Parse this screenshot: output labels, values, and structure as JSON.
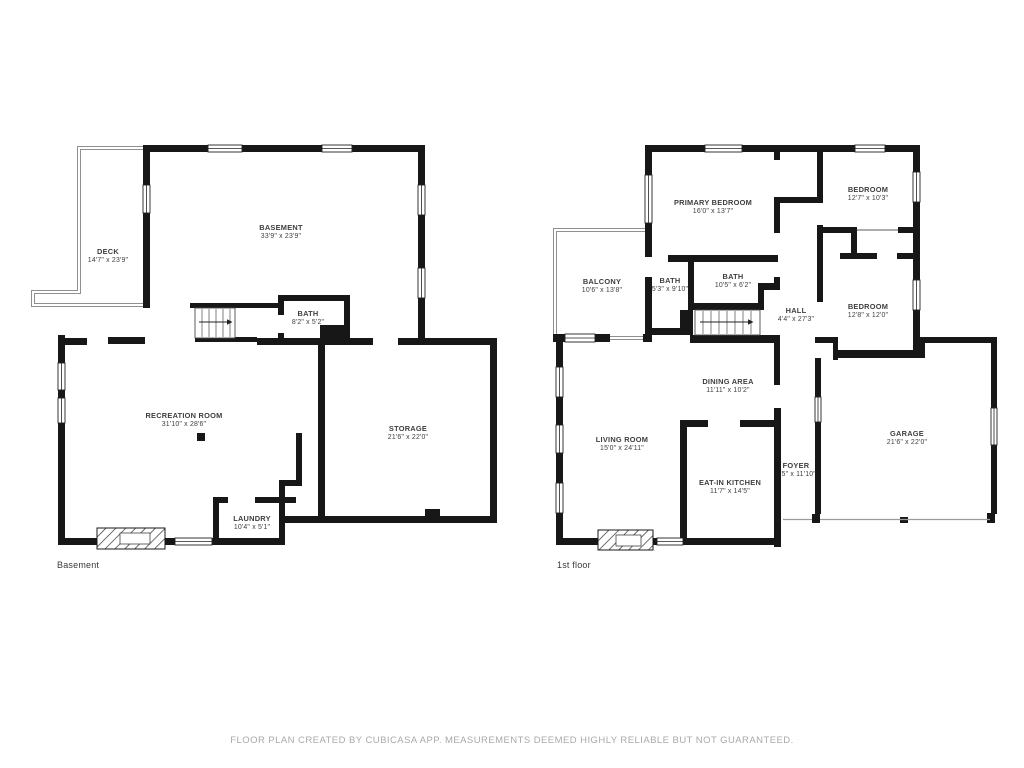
{
  "page": {
    "background": "#ffffff",
    "wall_color": "#171717",
    "label_color": "#3e3e3e",
    "disclaimer_color": "#a9a9a9"
  },
  "floors": [
    {
      "caption": "Basement",
      "rooms": [
        {
          "name": "DECK",
          "dims": "14'7\" x 23'9\""
        },
        {
          "name": "BASEMENT",
          "dims": "33'9\" x 23'9\""
        },
        {
          "name": "BATH",
          "dims": "8'2\" x 5'2\""
        },
        {
          "name": "RECREATION ROOM",
          "dims": "31'10\" x 28'6\""
        },
        {
          "name": "STORAGE",
          "dims": "21'6\" x 22'0\""
        },
        {
          "name": "LAUNDRY",
          "dims": "10'4\" x 5'1\""
        }
      ]
    },
    {
      "caption": "1st floor",
      "rooms": [
        {
          "name": "PRIMARY BEDROOM",
          "dims": "16'0\" x 13'7\""
        },
        {
          "name": "BEDROOM",
          "dims": "12'7\" x 10'3\""
        },
        {
          "name": "BALCONY",
          "dims": "10'6\" x 13'8\""
        },
        {
          "name": "BATH",
          "dims": "5'3\" x 9'10\""
        },
        {
          "name": "BATH",
          "dims": "10'5\" x 6'2\""
        },
        {
          "name": "HALL",
          "dims": "4'4\" x 27'3\""
        },
        {
          "name": "BEDROOM",
          "dims": "12'8\" x 12'0\""
        },
        {
          "name": "DINING AREA",
          "dims": "11'11\" x 10'2\""
        },
        {
          "name": "LIVING ROOM",
          "dims": "15'0\" x 24'11\""
        },
        {
          "name": "EAT-IN KITCHEN",
          "dims": "11'7\" x 14'5\""
        },
        {
          "name": "FOYER",
          "dims": "4'5\" x 11'10\""
        },
        {
          "name": "GARAGE",
          "dims": "21'6\" x 22'0\""
        }
      ]
    }
  ],
  "footer": {
    "disclaimer": "FLOOR PLAN CREATED BY CUBICASA APP. MEASUREMENTS DEEMED HIGHLY RELIABLE BUT NOT GUARANTEED."
  }
}
